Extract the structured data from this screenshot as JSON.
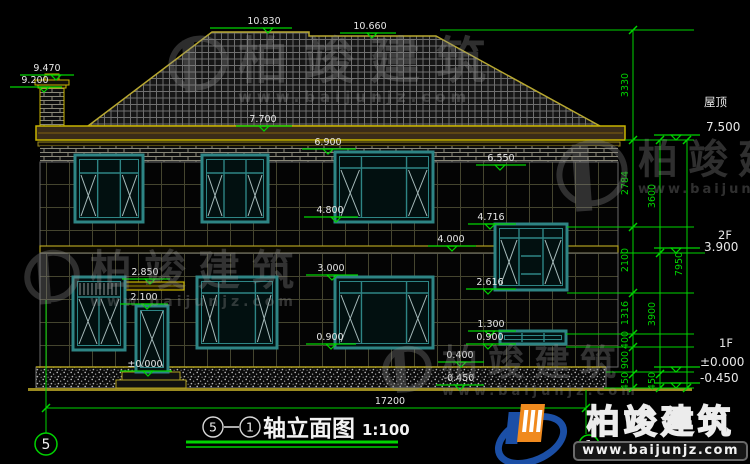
{
  "drawing": {
    "title": {
      "axis_from": "5",
      "axis_to": "1",
      "name": "轴立面图",
      "scale": "1:100"
    },
    "elevation_marks": {
      "m10830": "10.830",
      "m10660": "10.660",
      "m9470": "9.470",
      "m9200": "9.200",
      "m7700": "7.700",
      "m6900": "6.900",
      "m6550": "6.550",
      "m4800": "4.800",
      "m4716": "4.716",
      "m4000": "4.000",
      "m3000": "3.000",
      "m2850": "2.850",
      "m2616": "2.616",
      "m2100": "2.100",
      "m1300": "1.300",
      "m0900a": "0.900",
      "m0900b": "0.900",
      "m0400": "0.400",
      "m0000": "±0.000",
      "mneg0450a": "-0.450"
    },
    "right_annotations": {
      "roof_label": "屋顶",
      "roof_elev": "7.500",
      "floor2_label": "2F",
      "floor2_elev": "3.900",
      "floor1_label": "1F",
      "floor1_zero": "±0.000",
      "floor1_below": "-0.450"
    },
    "dim_chain_inner": [
      "3330",
      "2784",
      "2100",
      "1316",
      "400",
      "900",
      "450"
    ],
    "dim_chain_mid": [
      "3600",
      "3900",
      "450"
    ],
    "dim_total_right": "7950",
    "dim_total_width": "17200",
    "axis_bubbles": {
      "left": "5",
      "right": "1"
    }
  },
  "watermark": {
    "brand": "柏竣建筑",
    "url": "www.baijunjz.com"
  },
  "logo": {
    "brand": "柏竣建筑",
    "url": "www.baijunjz.com"
  },
  "colors": {
    "dim_green": "#00d400",
    "trim_yellow": "#c8b400",
    "window_teal": "#2e8585"
  }
}
